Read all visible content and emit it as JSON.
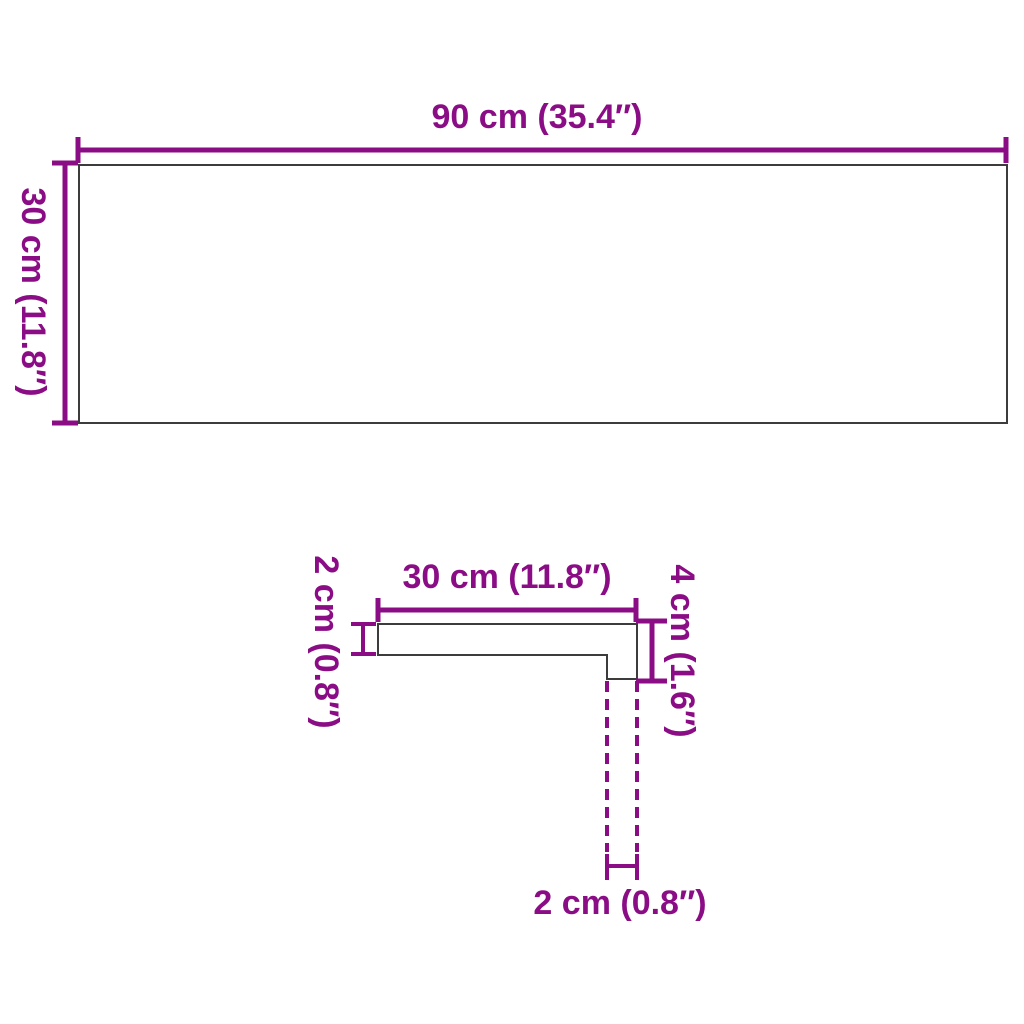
{
  "colors": {
    "accent": "#8B0D86",
    "outline": "#3C3C3C",
    "background": "#FFFFFF"
  },
  "top_view": {
    "width_label": "90 cm (35.4″)",
    "height_label": "30 cm (11.8″)"
  },
  "profile_view": {
    "width_label": "30 cm (11.8″)",
    "thickness_label": "2 cm (0.8″)",
    "height_label": "4 cm (1.6″)",
    "nose_width_label": "2 cm (0.8″)"
  }
}
